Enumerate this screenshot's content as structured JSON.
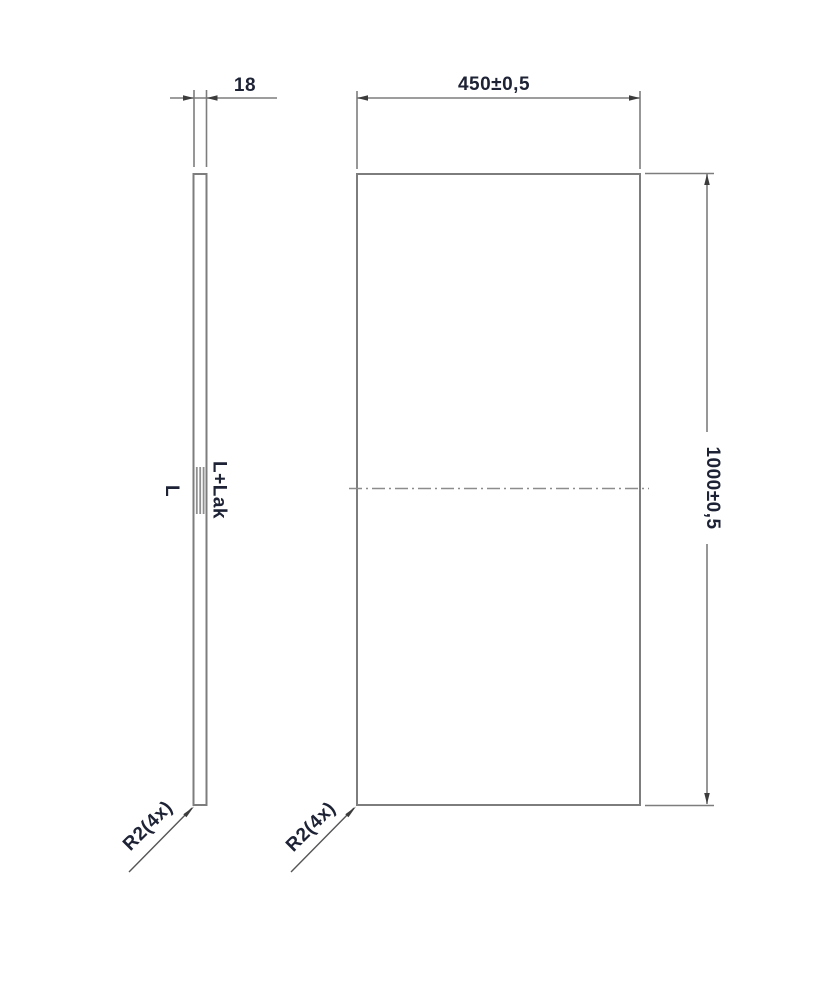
{
  "drawing": {
    "background_color": "#ffffff",
    "line_color": "#7d7d7d",
    "text_color": "#1d2235",
    "side_view": {
      "thickness_dim": "18",
      "finish_left": "L",
      "finish_right": "L+Lak",
      "corner_radius_note": "R2(4x)"
    },
    "front_view": {
      "width_dim": "450±0,5",
      "height_dim": "1000±0,5",
      "corner_radius_note": "R2(4x)"
    }
  }
}
